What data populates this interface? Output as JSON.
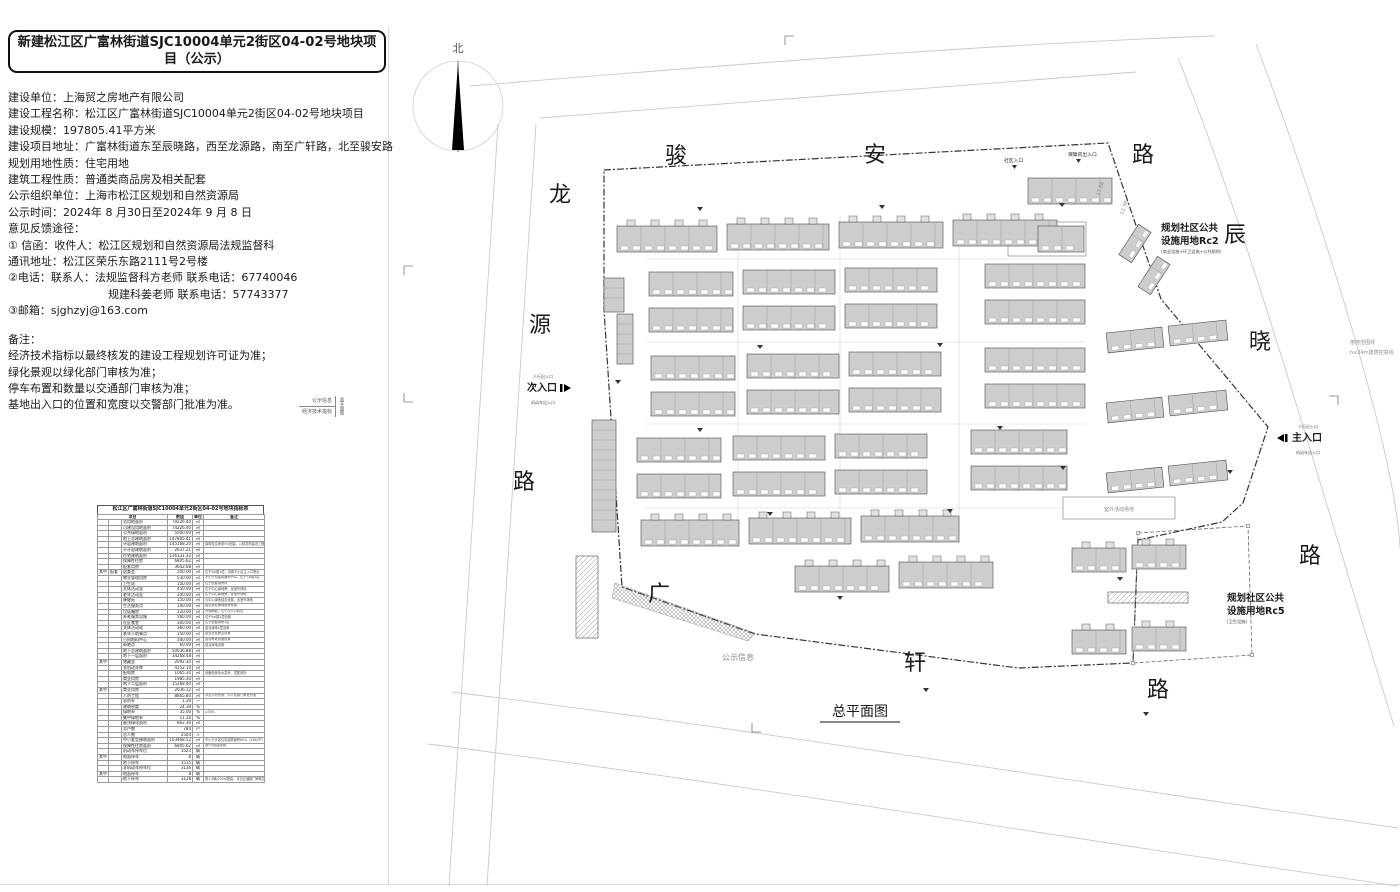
{
  "page": {
    "title": "新建松江区广富林街道SJC10004单元2街区04-02号地块项目（公示）"
  },
  "info": {
    "lines": [
      "建设单位：上海贸之房地产有限公司",
      "建设工程名称：松江区广富林街道SJC10004单元2街区04-02号地块项目",
      "建设规模：197805.41平方米",
      "建设项目地址：广富林街道东至辰晓路，西至龙源路，南至广轩路，北至骏安路",
      "规划用地性质：住宅用地",
      "建筑工程性质：普通类商品房及相关配套",
      "公示组织单位：上海市松江区规划和自然资源局",
      "公示时间：2024年 8 月30日至2024年 9 月 8 日",
      "意见反馈途径：",
      "① 信函：收件人：松江区规划和自然资源局法规监督科",
      "通讯地址：松江区荣乐东路2111号2号楼",
      "②电话：联系人：法规监督科方老师 联系电话：67740046",
      "规建科姜老师 联系电话：57743377",
      "③邮箱：sjghzyj@163.com"
    ]
  },
  "remarks": {
    "lines": [
      "备注：",
      "经济技术指标以最终核发的建设工程规划许可证为准；",
      "绿化景观以绿化部门审核为准；",
      "停车布置和数量以交通部门审核为准；",
      "基地出入口的位置和宽度以交警部门批准为准。"
    ]
  },
  "titleblock": {
    "row1": "公示信息",
    "row2": "经济技术指标",
    "side": "总平面图"
  },
  "table": {
    "title": "松江区广富林街道SJC10004单元2街区04-02号地块指标表",
    "header": {
      "item": "项目",
      "value": "数值",
      "unit": "单位",
      "note": "备注"
    },
    "rows": [
      [
        "",
        "",
        "总用地面积",
        "79226.40",
        "㎡",
        ""
      ],
      [
        "",
        "",
        "可建设用地面积",
        "74226.40",
        "㎡",
        ""
      ],
      [
        "",
        "",
        "公共绿地面积",
        "5000.00",
        "㎡",
        ""
      ],
      [
        "",
        "",
        "地上总建筑面积",
        "147805.41",
        "㎡",
        ""
      ],
      [
        "",
        "",
        "计容建筑面积",
        "145168.20",
        "㎡",
        "保障性住房按5%配建，以核发的建设工程规划许可证为准"
      ],
      [
        "",
        "",
        "不计容建筑面积",
        "2637.21",
        "㎡",
        ""
      ],
      [
        "",
        "",
        "住宅建筑面积",
        "136131.32",
        "㎡",
        ""
      ],
      [
        "",
        "",
        "保障性住房",
        "6805.62",
        "㎡",
        ""
      ],
      [
        "",
        "",
        "配套用房",
        "3642.08",
        "㎡",
        ""
      ],
      [
        "其中",
        "配套",
        "居委会",
        "200.00",
        "㎡",
        "位于5#楼1层，设置于小区主入口附近"
      ],
      [
        "",
        "",
        "物业管理用房",
        "530.00",
        "㎡",
        "不小于总建筑面积3‰，位于7#楼1层"
      ],
      [
        "",
        "",
        "卫生站",
        "150.00",
        "㎡",
        "位于配套用房内"
      ],
      [
        "",
        "",
        "文体活动室",
        "450.00",
        "㎡",
        "位于中心绿地旁，含室外场地"
      ],
      [
        "",
        "",
        "老年活动室",
        "200.00",
        "㎡",
        "位于中心绿地旁，含室外场地"
      ],
      [
        "",
        "",
        "康健苑",
        "150.00",
        "㎡",
        "与中心绿地结合设置，含室外场地"
      ],
      [
        "",
        "",
        "生活服务点",
        "100.00",
        "㎡",
        "结合物业管理用房设置"
      ],
      [
        "",
        "",
        "垃圾箱房",
        "120.00",
        "㎡",
        "分设两处，位于次入口附近"
      ],
      [
        "",
        "",
        "养老服务设施",
        "560.00",
        "㎡",
        "位于9#楼1层设置"
      ],
      [
        "",
        "",
        "社区食堂",
        "300.00",
        "㎡",
        "位于配套用房1层"
      ],
      [
        "",
        "",
        "文体活动站",
        "360.00",
        "㎡",
        "结合绿地1层设置"
      ],
      [
        "",
        "",
        "老年人助餐点",
        "150.00",
        "㎡",
        "结合社区食堂设置"
      ],
      [
        "",
        "",
        "日间照料中心",
        "300.00",
        "㎡",
        "结合养老设施设置"
      ],
      [
        "",
        "",
        "晾晒点",
        "60.00",
        "㎡",
        "结合绿地设置"
      ],
      [
        "",
        "",
        "地下总建筑面积",
        "50036.88",
        "㎡",
        ""
      ],
      [
        "",
        "",
        "地下一层面积",
        "34268.48",
        "㎡",
        ""
      ],
      [
        "其中",
        "",
        "储藏室",
        "2092.30",
        "㎡",
        ""
      ],
      [
        "",
        "",
        "非机动车库",
        "4152.10",
        "㎡",
        ""
      ],
      [
        "",
        "",
        "配电房",
        "1065.30",
        "㎡",
        "设备用房含水泵房、变配电所"
      ],
      [
        "",
        "",
        "商业用房",
        "1985.30",
        "㎡",
        ""
      ],
      [
        "",
        "",
        "地下二层面积",
        "15268.40",
        "㎡",
        ""
      ],
      [
        "其中",
        "",
        "商业用房",
        "2036.12",
        "㎡",
        ""
      ],
      [
        "",
        "",
        "人防工程",
        "8865.80",
        "㎡",
        "详见人防专篇，以人防部门审批为准"
      ],
      [
        "",
        "",
        "容积率",
        "1.29",
        "—",
        ""
      ],
      [
        "",
        "",
        "建筑密度",
        "24.39",
        "%",
        ""
      ],
      [
        "",
        "",
        "绿地率",
        "35.00",
        "%",
        "≥35%"
      ],
      [
        "",
        "",
        "集中绿地率",
        "11.20",
        "%",
        ""
      ],
      [
        "",
        "",
        "屋顶绿化面积",
        "862.30",
        "㎡",
        ""
      ],
      [
        "",
        "",
        "总户数",
        "784",
        "户",
        ""
      ],
      [
        "",
        "",
        "总人数",
        "2504",
        "人",
        ""
      ],
      [
        "",
        "",
        "中小套型建筑面积",
        "103468.52",
        "㎡",
        "不小于计容住宅建筑面积60%（2460户）"
      ],
      [
        "",
        "",
        "保障性住房面积",
        "6805.62",
        "㎡",
        "按5%配建设置"
      ],
      [
        "",
        "",
        "机动车停车位",
        "1523",
        "辆",
        ""
      ],
      [
        "其中",
        "",
        "地面停车",
        "8",
        "辆",
        ""
      ],
      [
        "",
        "",
        "地下停车",
        "1515",
        "辆",
        ""
      ],
      [
        "",
        "",
        "非机动车停车位",
        "3136",
        "辆",
        ""
      ],
      [
        "其中",
        "",
        "地面停车",
        "8",
        "辆",
        ""
      ],
      [
        "",
        "",
        "地下停车",
        "3128",
        "辆",
        "按1.5辆/100㎡配建，详见交通部门审核意见"
      ]
    ]
  },
  "plan": {
    "colors": {
      "building": "#cdcdcd",
      "building_dark": "#bdbdbd",
      "stroke": "#4a4a4a",
      "road": "#c9c9c9",
      "boundary": "#333333",
      "lane": "#d2d2d2"
    },
    "north_label": "北",
    "drawing_title": "总平面图",
    "road_labels": [
      {
        "t": "骏",
        "x": 676,
        "y": 163
      },
      {
        "t": "安",
        "x": 875,
        "y": 162
      },
      {
        "t": "路",
        "x": 1143,
        "y": 162
      },
      {
        "t": "龙",
        "x": 560,
        "y": 202
      },
      {
        "t": "源",
        "x": 540,
        "y": 332
      },
      {
        "t": "路",
        "x": 524,
        "y": 489
      },
      {
        "t": "辰",
        "x": 1235,
        "y": 242
      },
      {
        "t": "晓",
        "x": 1260,
        "y": 349
      },
      {
        "t": "路",
        "x": 1310,
        "y": 563
      },
      {
        "t": "广",
        "x": 659,
        "y": 601
      },
      {
        "t": "轩",
        "x": 915,
        "y": 670
      },
      {
        "t": "路",
        "x": 1158,
        "y": 697
      }
    ],
    "zones": [
      {
        "line1": "规划社区公共",
        "line2": "设施用地Rc2",
        "note": "(商业设施+环卫设施+公共厕所)",
        "x": 1161,
        "y": 231
      },
      {
        "line1": "规划社区公共",
        "line2": "设施用地Rc5",
        "note": "(卫生设施)",
        "x": 1227,
        "y": 601
      }
    ],
    "entrances": [
      {
        "label": "次入口",
        "sub_top": "人行出入口",
        "sub_bottom": "机动车出入口",
        "x": 527,
        "y": 391,
        "dir": "right"
      },
      {
        "label": "主入口",
        "sub_top": "人行出入口",
        "sub_bottom": "机动车出入口",
        "x": 1292,
        "y": 441,
        "dir": "left"
      },
      {
        "label": "社区入口",
        "x": 1004,
        "y": 162,
        "small": true
      },
      {
        "label": "保障房出入口",
        "x": 1068,
        "y": 156,
        "small": true
      }
    ],
    "tiny_notes": [
      {
        "t": "用地范围线",
        "x": 1350,
        "y": 344
      },
      {
        "t": "h≤24m建筑控高线",
        "x": 1350,
        "y": 354
      },
      {
        "t": "室外活动场地",
        "x": 1119,
        "y": 511,
        "anchor": "middle"
      },
      {
        "t": "公示信息",
        "x": 722,
        "y": 660,
        "s": 8
      },
      {
        "t": "17.58",
        "x": 1099,
        "y": 196,
        "rot": -70
      },
      {
        "t": "12.38",
        "x": 1123,
        "y": 215,
        "rot": -70
      }
    ],
    "boundary": "604,170 1108,143 1161,299 1268,427 1243,503 1222,522 1138,540 1133,663 1018,668 755,634 622,587 604,310",
    "rc5_outline": "1138,533 1248,526 1252,655 1133,663",
    "road_lines": [
      "M540,118 C760,100 980,84 1136,72",
      "M470,86 C760,62 1000,44 1214,36",
      "M1178,58 C1252,240 1330,520 1394,726",
      "M1256,44 C1330,240 1396,460 1400,548",
      "M536,124 L487,886",
      "M498,124 L449,886",
      "M452,692 C760,730 1060,780 1398,828",
      "M428,744 C760,786 1060,838 1398,886"
    ],
    "lanes": {
      "v": [
        738,
        840,
        959
      ],
      "v_range": [
        215,
        545
      ],
      "h": [
        259,
        342,
        424,
        508
      ],
      "h_range": [
        645,
        1085
      ]
    },
    "slabs": [
      [
        617,
        226,
        100,
        26,
        1
      ],
      [
        727,
        224,
        102,
        26,
        1
      ],
      [
        839,
        222,
        104,
        26,
        1
      ],
      [
        953,
        220,
        104,
        26,
        1
      ],
      [
        1028,
        178,
        84,
        26,
        0
      ],
      [
        649,
        272,
        84,
        24,
        0
      ],
      [
        743,
        270,
        92,
        24,
        0
      ],
      [
        845,
        268,
        92,
        24,
        0
      ],
      [
        985,
        264,
        100,
        24,
        0
      ],
      [
        649,
        308,
        84,
        24,
        0
      ],
      [
        743,
        306,
        92,
        24,
        0
      ],
      [
        845,
        304,
        92,
        24,
        0
      ],
      [
        985,
        300,
        100,
        24,
        0
      ],
      [
        651,
        356,
        84,
        24,
        0
      ],
      [
        747,
        354,
        92,
        24,
        0
      ],
      [
        849,
        352,
        92,
        24,
        0
      ],
      [
        985,
        348,
        100,
        24,
        0
      ],
      [
        651,
        392,
        84,
        24,
        0
      ],
      [
        747,
        390,
        92,
        24,
        0
      ],
      [
        849,
        388,
        92,
        24,
        0
      ],
      [
        985,
        384,
        100,
        24,
        0
      ],
      [
        637,
        438,
        84,
        24,
        0
      ],
      [
        733,
        436,
        92,
        24,
        0
      ],
      [
        835,
        434,
        92,
        24,
        0
      ],
      [
        971,
        430,
        96,
        24,
        0
      ],
      [
        637,
        474,
        84,
        24,
        0
      ],
      [
        733,
        472,
        92,
        24,
        0
      ],
      [
        835,
        470,
        92,
        24,
        0
      ],
      [
        971,
        466,
        96,
        24,
        0
      ],
      [
        641,
        520,
        98,
        26,
        1
      ],
      [
        749,
        518,
        102,
        26,
        1
      ],
      [
        861,
        516,
        98,
        26,
        1
      ],
      [
        795,
        566,
        94,
        26,
        1
      ],
      [
        899,
        562,
        94,
        26,
        1
      ],
      [
        1107,
        330,
        56,
        20,
        0,
        -6
      ],
      [
        1169,
        323,
        58,
        20,
        0,
        -6
      ],
      [
        1107,
        400,
        56,
        20,
        0,
        -6
      ],
      [
        1169,
        393,
        58,
        20,
        0,
        -6
      ],
      [
        1107,
        470,
        56,
        20,
        0,
        -6
      ],
      [
        1169,
        463,
        58,
        20,
        0,
        -6
      ],
      [
        1117,
        236,
        36,
        15,
        0,
        -57
      ],
      [
        1136,
        268,
        36,
        15,
        0,
        -57
      ],
      [
        1072,
        548,
        54,
        24,
        1
      ],
      [
        1132,
        545,
        54,
        24,
        1
      ],
      [
        1108,
        592,
        80,
        11,
        2
      ],
      [
        1072,
        630,
        54,
        24,
        1
      ],
      [
        1132,
        627,
        54,
        24,
        1
      ],
      [
        604,
        278,
        20,
        34,
        3
      ],
      [
        617,
        314,
        16,
        50,
        3
      ],
      [
        592,
        420,
        24,
        112,
        3
      ],
      [
        576,
        556,
        22,
        82,
        2
      ],
      [
        1038,
        226,
        46,
        26,
        0
      ]
    ],
    "outline_rects": [
      [
        1008,
        222,
        78,
        34
      ],
      [
        1063,
        497,
        112,
        22
      ]
    ],
    "hatch_wedge": "615,583 755,633 748,641 612,598"
  }
}
